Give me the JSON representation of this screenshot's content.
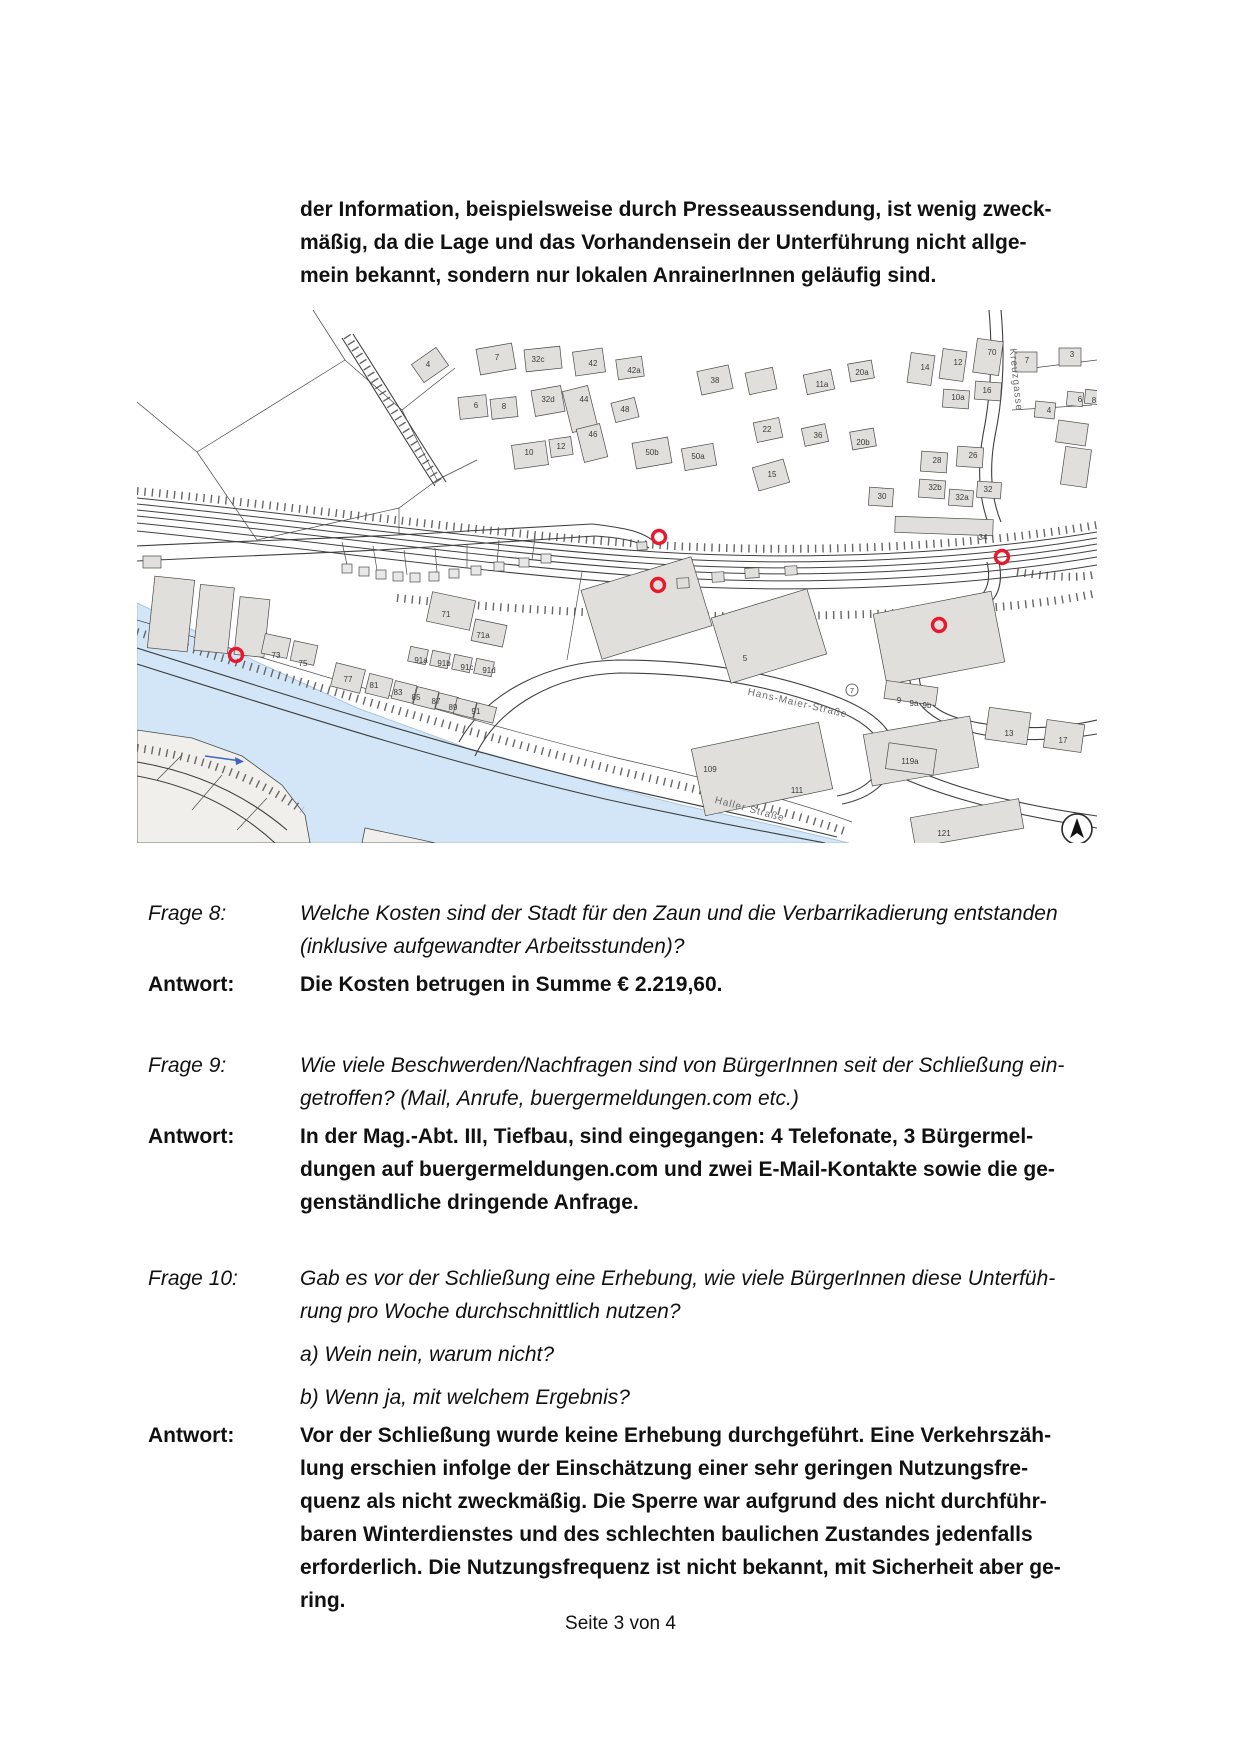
{
  "intro": {
    "lines": [
      "der Information, beispielsweise durch Presseaussendung, ist wenig zweck-",
      "mäßig, da die Lage und das Vorhandensein der Unterführung nicht allge-",
      "mein bekannt, sondern nur lokalen AnrainerInnen geläufig sind."
    ]
  },
  "qa": [
    {
      "label": "Frage 8:",
      "q_lines": [
        "Welche Kosten sind der Stadt für den Zaun und die Verbarrikadierung entstanden",
        "(inklusive aufgewandter Arbeitsstunden)?"
      ],
      "a_label": "Antwort:",
      "a_lines": [
        "Die Kosten betrugen in Summe € 2.219,60."
      ]
    },
    {
      "label": "Frage 9:",
      "q_lines": [
        "Wie viele Beschwerden/Nachfragen sind von BürgerInnen seit der Schließung ein-",
        "getroffen? (Mail, Anrufe, buergermeldungen.com etc.)"
      ],
      "a_label": "Antwort:",
      "a_lines": [
        "In der Mag.-Abt. III, Tiefbau, sind eingegangen: 4 Telefonate, 3 Bürgermel-",
        "dungen auf buergermeldungen.com und zwei E-Mail-Kontakte sowie die ge-",
        "genständliche dringende Anfrage."
      ]
    },
    {
      "label": "Frage 10:",
      "q_lines": [
        "Gab es vor der Schließung eine Erhebung, wie viele BürgerInnen diese Unterfüh-",
        "rung pro Woche durchschnittlich nutzen?"
      ],
      "sub_lines": [
        "a) Wein nein, warum nicht?",
        "b) Wenn ja, mit welchem Ergebnis?"
      ],
      "a_label": "Antwort:",
      "a_lines": [
        "Vor der Schließung wurde keine Erhebung durchgeführt. Eine Verkehrszäh-",
        "lung erschien infolge der Einschätzung einer sehr geringen Nutzungsfre-",
        "quenz als nicht zweckmäßig. Die Sperre war aufgrund des nicht durchführ-",
        "baren Winterdienstes und des schlechten baulichen Zustandes jedenfalls",
        "erforderlich. Die Nutzungsfrequenz ist nicht bekannt, mit Sicherheit aber ge-",
        "ring."
      ]
    }
  ],
  "footer": {
    "page_label": "Seite 3 von 4"
  },
  "map": {
    "colors": {
      "water": "#d3e6f7",
      "water_edge": "#a9c7e2",
      "building": "#e0dfdc",
      "land": "#f1efec",
      "line": "#4a4a4a",
      "marker": "#e8192c",
      "arrow": "#3b66c4"
    },
    "water": "0,293 40,312 120,352 220,398 330,438 440,468 540,494 640,516 712,533 0,533",
    "land_patches": [
      "0,420 55,428 105,446 145,475 168,505 173,533 0,533",
      "228,518 285,530 298,533 225,533"
    ],
    "misc_lines": [
      "M60,142 L208,50 L265,100 L300,170 L262,198 L120,230 L60,142",
      "M208,50 L176,0",
      "M0,92 L60,142",
      "M265,100 L318,58",
      "M300,170 L340,150",
      "M262,198 L262,225",
      "M20,470 L45,445",
      "M55,500 L85,465",
      "M100,520 L130,488",
      "M880,60 L960,50",
      "M875,100 L955,95",
      "M210,255 L205,232",
      "M240,260 L236,236",
      "M270,265 L267,240",
      "M300,262 L298,238",
      "M330,258 L330,234",
      "M360,254 L362,230",
      "M395,250 L398,227",
      "M430,350 L445,262",
      "M0,310 C150,355 320,408 480,448 C590,473 660,492 715,512"
    ],
    "hatches": [
      "M0,322 C150,368 320,420 478,460 C585,485 655,503 710,522",
      "M0,181 C180,199 360,225 520,235 C670,244 830,237 960,215",
      "M260,288 C420,305 600,310 760,303 C860,299 920,292 960,283",
      "M0,438 C60,446 120,468 165,500",
      "M210,26 C240,73 270,123 303,174",
      "M880,262 C920,268 945,268 960,264"
    ],
    "rail_lines": [
      "M0,188 C180,206 360,232 520,242 C670,251 830,244 960,222",
      "M0,194 C180,212 360,238 520,248 C670,257 830,250 960,228",
      "M0,200 C180,218 360,244 520,254 C670,263 830,256 960,234",
      "M0,206 C180,224 360,250 520,260 C670,269 830,262 960,240",
      "M0,213 C180,231 360,257 520,267 C670,276 830,269 960,247",
      "M0,221 C180,239 360,265 520,275 C670,284 830,277 960,255"
    ],
    "roads": [
      "M0,236 C120,230 230,228 330,221 C380,218 420,216 455,214",
      "M0,251 C120,245 230,242 335,234 C385,231 425,228 458,226",
      "M455,214 C490,218 505,222 515,230",
      "M458,226 C488,228 502,232 512,238",
      "M0,338 C140,382 300,434 470,475 C570,498 640,512 700,527",
      "M0,354 C140,398 300,450 468,489 C562,510 632,522 688,533",
      "M322,432 C350,382 410,352 480,350 C570,350 645,365 703,388 C742,404 762,424 757,450 C753,472 735,488 705,494",
      "M338,446 C362,396 418,365 482,363 C568,363 638,377 696,399 C730,412 748,429 744,450 C741,468 726,481 700,486",
      "M862,252 C868,282 856,298 826,308 C798,317 784,330 782,356 C780,386 795,402 828,410",
      "M850,252 C856,278 846,291 818,300 C792,309 774,324 772,354 C770,388 788,408 826,420",
      "M828,410 C870,420 915,420 960,410",
      "M826,420 C868,432 915,432 960,424",
      "M852,0 C856,45 854,85 846,125 C840,158 842,190 852,215",
      "M864,0 C868,45 866,88 858,126 C852,158 854,188 864,212",
      "M757,450 C800,472 860,492 960,506",
      "M752,462 C798,484 858,502 960,518",
      "M0,452 C60,462 110,486 150,520",
      "M0,466 C55,476 100,498 138,533",
      "M205,28 C235,75 265,125 298,176",
      "M216,24 C246,71 276,121 309,172"
    ],
    "buildings": [
      [
        278,
        44,
        30,
        22,
        -35
      ],
      [
        341,
        36,
        36,
        26,
        -10
      ],
      [
        388,
        38,
        36,
        22,
        -6
      ],
      [
        437,
        40,
        30,
        24,
        -8
      ],
      [
        480,
        48,
        26,
        20,
        -8
      ],
      [
        322,
        86,
        28,
        22,
        -6
      ],
      [
        354,
        88,
        26,
        20,
        -6
      ],
      [
        396,
        78,
        30,
        26,
        -10
      ],
      [
        430,
        78,
        26,
        42,
        -14
      ],
      [
        443,
        116,
        24,
        34,
        -14
      ],
      [
        476,
        90,
        24,
        20,
        -14
      ],
      [
        376,
        133,
        34,
        24,
        -8
      ],
      [
        413,
        128,
        22,
        18,
        -8
      ],
      [
        497,
        130,
        36,
        26,
        -10
      ],
      [
        546,
        136,
        32,
        22,
        -10
      ],
      [
        618,
        153,
        32,
        24,
        -16
      ],
      [
        562,
        58,
        32,
        24,
        -12
      ],
      [
        610,
        60,
        28,
        22,
        -12
      ],
      [
        668,
        62,
        28,
        20,
        -12
      ],
      [
        712,
        52,
        24,
        18,
        -10
      ],
      [
        714,
        120,
        24,
        18,
        -10
      ],
      [
        618,
        110,
        26,
        20,
        -12
      ],
      [
        666,
        116,
        24,
        18,
        -12
      ],
      [
        772,
        44,
        24,
        30,
        8
      ],
      [
        804,
        40,
        24,
        30,
        8
      ],
      [
        838,
        30,
        26,
        34,
        8
      ],
      [
        878,
        42,
        22,
        20,
        0
      ],
      [
        922,
        38,
        22,
        18,
        0
      ],
      [
        806,
        80,
        26,
        18,
        4
      ],
      [
        838,
        72,
        26,
        18,
        4
      ],
      [
        898,
        92,
        20,
        16,
        6
      ],
      [
        930,
        82,
        16,
        14,
        6
      ],
      [
        948,
        80,
        14,
        14,
        6
      ],
      [
        784,
        142,
        26,
        20,
        4
      ],
      [
        820,
        137,
        26,
        20,
        4
      ],
      [
        782,
        170,
        26,
        18,
        4
      ],
      [
        812,
        180,
        24,
        16,
        4
      ],
      [
        840,
        172,
        24,
        16,
        4
      ],
      [
        732,
        178,
        24,
        18,
        4
      ],
      [
        758,
        208,
        98,
        16,
        2
      ],
      [
        920,
        112,
        30,
        22,
        8
      ],
      [
        926,
        138,
        26,
        38,
        8
      ],
      [
        14,
        268,
        40,
        72,
        6
      ],
      [
        60,
        276,
        34,
        66,
        6
      ],
      [
        100,
        288,
        30,
        58,
        6
      ],
      [
        6,
        246,
        18,
        12,
        0
      ],
      [
        126,
        326,
        26,
        20,
        12
      ],
      [
        155,
        333,
        24,
        20,
        12
      ],
      [
        196,
        356,
        30,
        24,
        14
      ],
      [
        230,
        366,
        24,
        20,
        14
      ],
      [
        256,
        373,
        22,
        18,
        14
      ],
      [
        278,
        379,
        22,
        18,
        14
      ],
      [
        300,
        385,
        20,
        16,
        14
      ],
      [
        318,
        390,
        20,
        16,
        14
      ],
      [
        338,
        395,
        20,
        16,
        14
      ],
      [
        272,
        338,
        18,
        15,
        12
      ],
      [
        294,
        342,
        18,
        15,
        12
      ],
      [
        316,
        346,
        18,
        15,
        12
      ],
      [
        338,
        350,
        18,
        15,
        12
      ],
      [
        292,
        286,
        44,
        30,
        12
      ],
      [
        336,
        312,
        32,
        22,
        12
      ],
      [
        452,
        262,
        115,
        72,
        -17
      ],
      [
        582,
        292,
        100,
        68,
        -17
      ],
      [
        742,
        292,
        120,
        72,
        -11
      ],
      [
        560,
        425,
        130,
        68,
        -12
      ],
      [
        730,
        415,
        108,
        52,
        -10
      ],
      [
        775,
        498,
        110,
        30,
        -10
      ],
      [
        748,
        374,
        52,
        18,
        8
      ],
      [
        850,
        400,
        42,
        32,
        8
      ],
      [
        908,
        412,
        38,
        28,
        8
      ],
      [
        750,
        436,
        48,
        26,
        8
      ],
      [
        540,
        268,
        12,
        10,
        -3
      ],
      [
        575,
        262,
        12,
        10,
        -3
      ],
      [
        608,
        258,
        14,
        10,
        -3
      ],
      [
        648,
        256,
        12,
        9,
        -3
      ],
      [
        500,
        232,
        10,
        8,
        -3
      ]
    ],
    "tiny_squares": [
      [
        205,
        254
      ],
      [
        222,
        257
      ],
      [
        239,
        260
      ],
      [
        256,
        262
      ],
      [
        273,
        263
      ],
      [
        292,
        262
      ],
      [
        312,
        259
      ],
      [
        334,
        256
      ],
      [
        357,
        252
      ],
      [
        382,
        248
      ],
      [
        404,
        244
      ]
    ],
    "house_numbers": [
      [
        291,
        57,
        "4"
      ],
      [
        360,
        50,
        "7"
      ],
      [
        401,
        52,
        "32c"
      ],
      [
        456,
        56,
        "42"
      ],
      [
        497,
        63,
        "42a"
      ],
      [
        339,
        98,
        "6"
      ],
      [
        367,
        99,
        "8"
      ],
      [
        411,
        92,
        "32d"
      ],
      [
        447,
        92,
        "44"
      ],
      [
        488,
        102,
        "48"
      ],
      [
        456,
        127,
        "46"
      ],
      [
        392,
        145,
        "10"
      ],
      [
        424,
        139,
        "12"
      ],
      [
        515,
        145,
        "50b"
      ],
      [
        561,
        149,
        "50a"
      ],
      [
        635,
        167,
        "15"
      ],
      [
        578,
        73,
        "38"
      ],
      [
        685,
        77,
        "11a"
      ],
      [
        725,
        65,
        "20a"
      ],
      [
        726,
        135,
        "20b"
      ],
      [
        630,
        122,
        "22"
      ],
      [
        681,
        128,
        "36"
      ],
      [
        788,
        60,
        "14"
      ],
      [
        821,
        55,
        "12"
      ],
      [
        855,
        45,
        "70"
      ],
      [
        890,
        53,
        "7"
      ],
      [
        935,
        47,
        "3"
      ],
      [
        850,
        83,
        "16"
      ],
      [
        821,
        90,
        "10a"
      ],
      [
        912,
        103,
        "4"
      ],
      [
        943,
        92,
        "6"
      ],
      [
        957,
        93,
        "8"
      ],
      [
        800,
        153,
        "28"
      ],
      [
        836,
        148,
        "26"
      ],
      [
        798,
        180,
        "32b"
      ],
      [
        825,
        190,
        "32a"
      ],
      [
        851,
        182,
        "32"
      ],
      [
        745,
        189,
        "30"
      ],
      [
        846,
        230,
        "34"
      ],
      [
        139,
        348,
        "73"
      ],
      [
        166,
        356,
        "75"
      ],
      [
        211,
        372,
        "77"
      ],
      [
        237,
        378,
        "81"
      ],
      [
        261,
        385,
        "83"
      ],
      [
        279,
        390,
        "85"
      ],
      [
        299,
        394,
        "87"
      ],
      [
        316,
        400,
        "89"
      ],
      [
        339,
        404,
        "91"
      ],
      [
        284,
        353,
        "91a"
      ],
      [
        307,
        356,
        "91b"
      ],
      [
        330,
        360,
        "91c"
      ],
      [
        352,
        363,
        "91d"
      ],
      [
        309,
        307,
        "71"
      ],
      [
        346,
        328,
        "71a"
      ],
      [
        608,
        351,
        "5"
      ],
      [
        573,
        462,
        "109"
      ],
      [
        660,
        483,
        "111"
      ],
      [
        762,
        393,
        "9"
      ],
      [
        777,
        396,
        "9a"
      ],
      [
        790,
        398,
        "9b"
      ],
      [
        872,
        426,
        "13"
      ],
      [
        926,
        433,
        "17"
      ],
      [
        773,
        454,
        "119a"
      ],
      [
        807,
        526,
        "121"
      ]
    ],
    "circled": [
      [
        715,
        380,
        "7"
      ]
    ],
    "street_labels": [
      {
        "t": "Hans-Maier-Straße",
        "x": 660,
        "y": 396,
        "r": 13
      },
      {
        "t": "Haller Straße",
        "x": 612,
        "y": 502,
        "r": 15
      },
      {
        "t": "Kreuzgasse",
        "x": 876,
        "y": 70,
        "r": 84
      }
    ],
    "markers": [
      [
        522,
        227
      ],
      [
        521,
        275
      ],
      [
        865,
        247
      ],
      [
        802,
        315
      ],
      [
        99,
        345
      ]
    ],
    "flow_arrow": {
      "x1": 68,
      "y1": 446,
      "x2": 104,
      "y2": 451
    },
    "north": {
      "x": 940,
      "y": 519,
      "r": 15
    }
  }
}
